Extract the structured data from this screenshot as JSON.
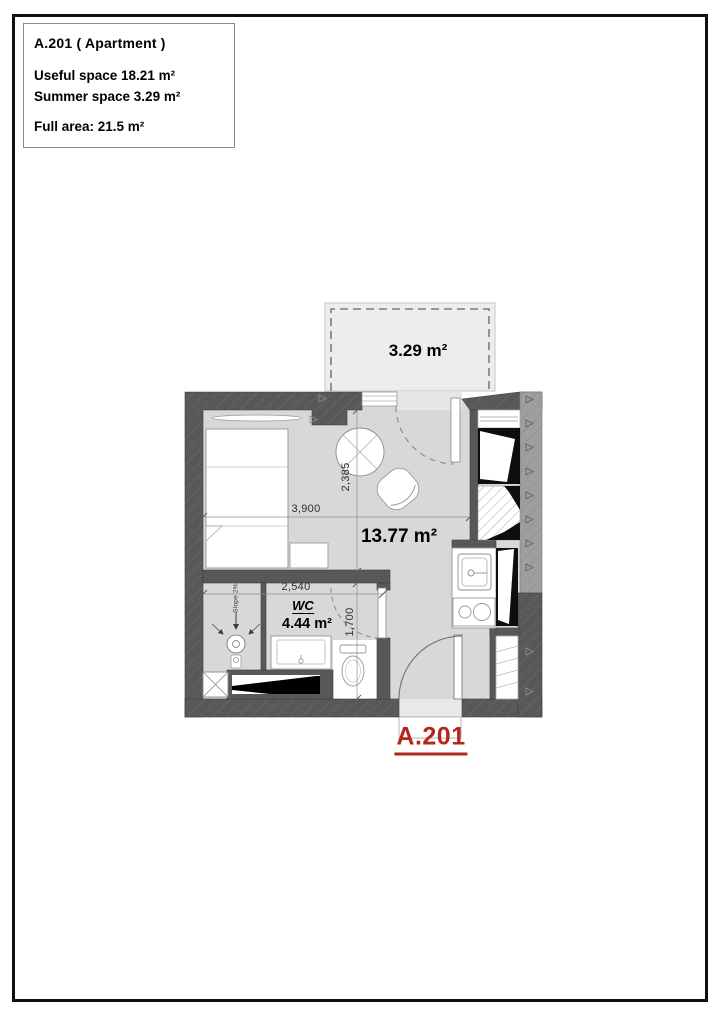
{
  "document": {
    "title_block": {
      "title": "A.201 ( Apartment )",
      "useful_space": "Useful space 18.21 m²",
      "summer_space": "Summer space 3.29 m²",
      "full_area": "Full area: 21.5 m²"
    },
    "plan": {
      "apartment_id": "A.201",
      "balcony_area": "3.29 m²",
      "living_area": "13.77 m²",
      "wc": {
        "label": "WC",
        "area": "4.44 m²",
        "slope": "Slope 2%"
      },
      "dimensions": {
        "living_width": "3,900",
        "living_depth": "2,385",
        "wc_width": "2,540",
        "wc_depth": "1,700"
      },
      "colors": {
        "wall_dark": "#57585a",
        "wall_light": "#9e9e9e",
        "floor": "#d8d8d8",
        "balcony": "#ededed",
        "label_red": "#b3271e"
      }
    }
  }
}
